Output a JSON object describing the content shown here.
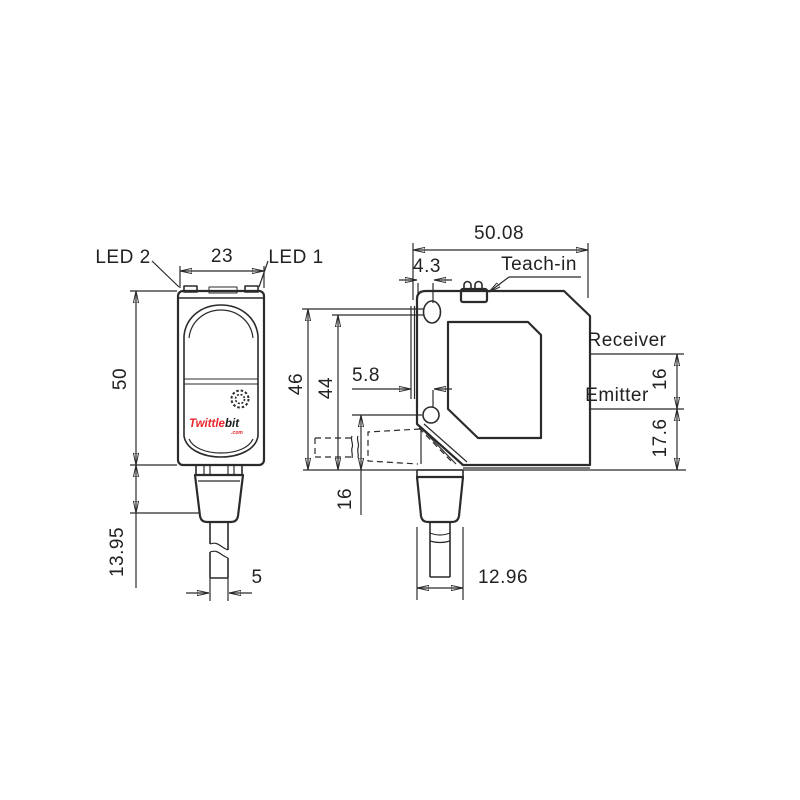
{
  "front_view": {
    "led2_label": "LED 2",
    "led1_label": "LED 1",
    "dim_width": "23",
    "dim_height": "50",
    "dim_connector_height": "13.95",
    "dim_cable_diameter": "5",
    "logo": {
      "prefix": "Twittle",
      "suffix": "bit",
      "domain": ".com"
    }
  },
  "side_view": {
    "dim_depth": "50.08",
    "dim_hole_top_offset": "4.3",
    "teach_in_label": "Teach-in",
    "receiver_label": "Receiver",
    "emitter_label": "Emitter",
    "dim_height_to_hole_top": "46",
    "dim_height_to_hole_center": "44",
    "dim_hole_side_offset": "5.8",
    "dim_hole_to_bottom": "16",
    "dim_receiver_to_emitter": "16",
    "dim_emitter_to_bottom": "17.6",
    "dim_connector_width": "12.96"
  },
  "colors": {
    "line": "#2b2b2b",
    "logo_red": "#e8252b"
  }
}
